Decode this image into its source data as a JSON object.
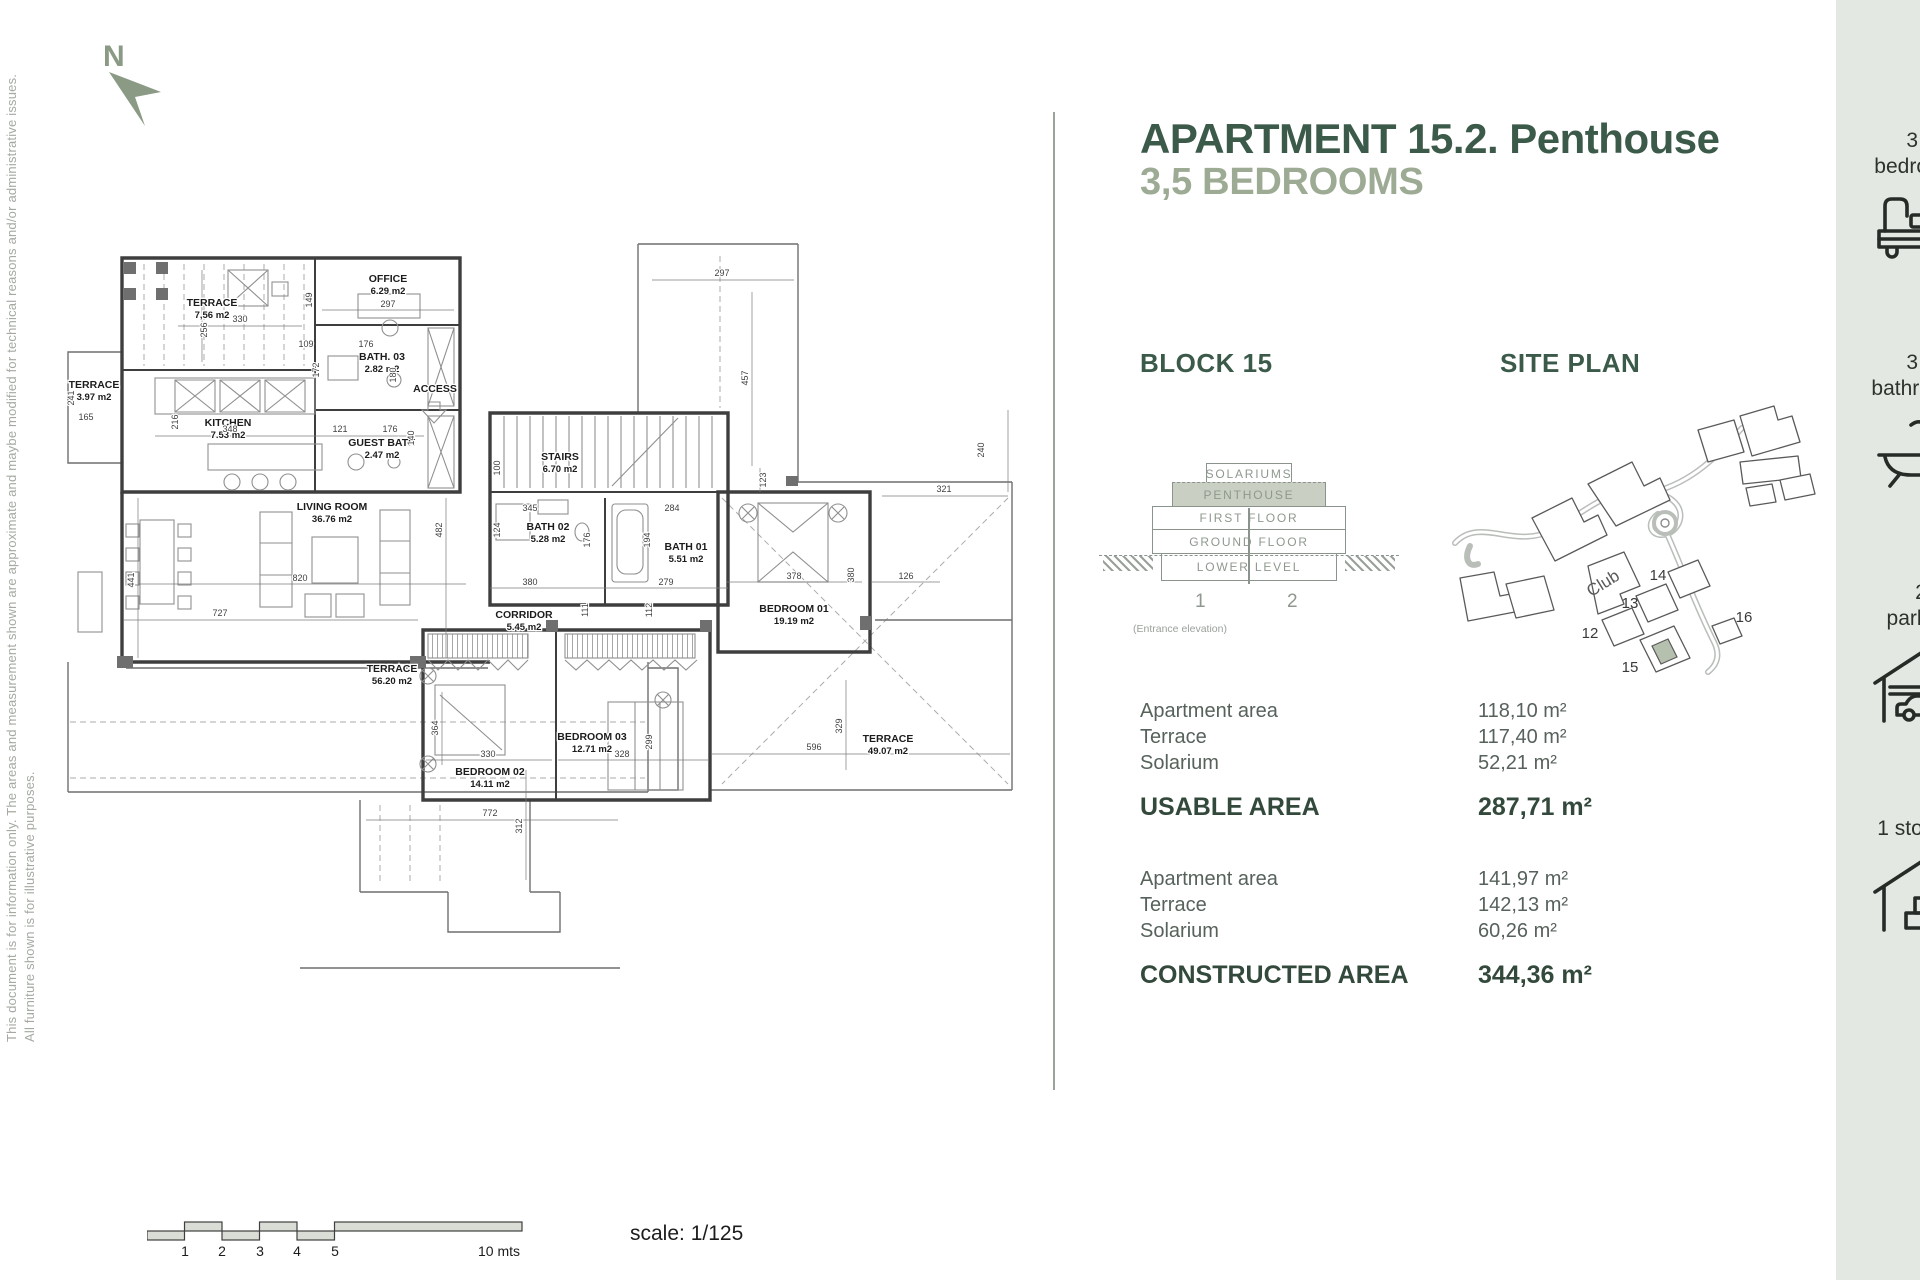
{
  "page_title_line1": "APARTMENT 15.2. Penthouse",
  "page_title_line2": "3,5 BEDROOMS",
  "north_label": "N",
  "disclaimers": {
    "line1": "This document is for information only. The areas and measurement shown are approximate and maybe modified for technical reasons and/or administrative issues.",
    "line2": "All furniture shown is for illustrative purposes."
  },
  "colors": {
    "accent_dark_green": "#3c5a4a",
    "accent_sage": "#9dab95",
    "sidebar_bg": "#e4e8e2",
    "penthouse_fill": "#c9d0c3"
  },
  "floor_plan": {
    "access": {
      "label": "ACCESS",
      "x": 375,
      "y": 162
    },
    "rooms": [
      {
        "label": "TERRACE",
        "area": "7,56 m2",
        "x": 152,
        "y": 76
      },
      {
        "label": "OFFICE",
        "area": "6.29 m2",
        "x": 328,
        "y": 52
      },
      {
        "label": "BATH. 03",
        "area": "2.82 m2",
        "x": 322,
        "y": 130
      },
      {
        "label": "KITCHEN",
        "area": "7.53 m2",
        "x": 168,
        "y": 196
      },
      {
        "label": "GUEST BATH",
        "area": "2.47 m2",
        "x": 322,
        "y": 216
      },
      {
        "label": "TERRACE",
        "area": "3.97 m2",
        "x": 34,
        "y": 158
      },
      {
        "label": "STAIRS",
        "area": "6.70 m2",
        "x": 500,
        "y": 230
      },
      {
        "label": "BATH 02",
        "area": "5.28 m2",
        "x": 488,
        "y": 300
      },
      {
        "label": "BATH 01",
        "area": "5.51 m2",
        "x": 626,
        "y": 320
      },
      {
        "label": "CORRIDOR",
        "area": "5.45 m2",
        "x": 464,
        "y": 388
      },
      {
        "label": "LIVING ROOM",
        "area": "36.76 m2",
        "x": 272,
        "y": 280
      },
      {
        "label": "TERRACE",
        "area": "56.20 m2",
        "x": 332,
        "y": 442
      },
      {
        "label": "BEDROOM 02",
        "area": "14.11 m2",
        "x": 430,
        "y": 545
      },
      {
        "label": "BEDROOM 03",
        "area": "12.71 m2",
        "x": 532,
        "y": 510
      },
      {
        "label": "BEDROOM 01",
        "area": "19.19 m2",
        "x": 734,
        "y": 382
      },
      {
        "label": "TERRACE",
        "area": "49.07 m2",
        "x": 828,
        "y": 512
      }
    ],
    "dimensions": [
      {
        "v": "256",
        "x": 147,
        "y": 100,
        "r": -90
      },
      {
        "v": "330",
        "x": 180,
        "y": 92
      },
      {
        "v": "149",
        "x": 252,
        "y": 70,
        "r": -90
      },
      {
        "v": "297",
        "x": 328,
        "y": 77
      },
      {
        "v": "109",
        "x": 246,
        "y": 117
      },
      {
        "v": "176",
        "x": 306,
        "y": 117
      },
      {
        "v": "172",
        "x": 259,
        "y": 140,
        "r": -90
      },
      {
        "v": "180",
        "x": 336,
        "y": 145,
        "r": -90
      },
      {
        "v": "216",
        "x": 118,
        "y": 192,
        "r": -90
      },
      {
        "v": "348",
        "x": 170,
        "y": 202
      },
      {
        "v": "121",
        "x": 280,
        "y": 202
      },
      {
        "v": "176",
        "x": 330,
        "y": 202
      },
      {
        "v": "140",
        "x": 354,
        "y": 208,
        "r": -90
      },
      {
        "v": "241",
        "x": 14,
        "y": 168,
        "r": -90
      },
      {
        "v": "165",
        "x": 26,
        "y": 190
      },
      {
        "v": "100",
        "x": 440,
        "y": 238,
        "r": -90
      },
      {
        "v": "482",
        "x": 382,
        "y": 300,
        "r": -90
      },
      {
        "v": "345",
        "x": 470,
        "y": 281
      },
      {
        "v": "124",
        "x": 440,
        "y": 300,
        "r": -90
      },
      {
        "v": "176",
        "x": 530,
        "y": 310,
        "r": -90
      },
      {
        "v": "380",
        "x": 470,
        "y": 355
      },
      {
        "v": "279",
        "x": 606,
        "y": 355
      },
      {
        "v": "111",
        "x": 528,
        "y": 380,
        "r": -90
      },
      {
        "v": "112",
        "x": 592,
        "y": 380,
        "r": -90
      },
      {
        "v": "284",
        "x": 612,
        "y": 281
      },
      {
        "v": "194",
        "x": 590,
        "y": 310,
        "r": -90
      },
      {
        "v": "820",
        "x": 240,
        "y": 351
      },
      {
        "v": "364",
        "x": 378,
        "y": 498,
        "r": -90
      },
      {
        "v": "330",
        "x": 428,
        "y": 527
      },
      {
        "v": "328",
        "x": 562,
        "y": 527
      },
      {
        "v": "299",
        "x": 592,
        "y": 512,
        "r": -90
      },
      {
        "v": "378",
        "x": 734,
        "y": 349
      },
      {
        "v": "380",
        "x": 794,
        "y": 345,
        "r": -90
      },
      {
        "v": "126",
        "x": 846,
        "y": 349
      },
      {
        "v": "321",
        "x": 884,
        "y": 262
      },
      {
        "v": "240",
        "x": 924,
        "y": 220,
        "r": -90
      },
      {
        "v": "123",
        "x": 706,
        "y": 250,
        "r": -90
      },
      {
        "v": "457",
        "x": 688,
        "y": 148,
        "r": -90
      },
      {
        "v": "297",
        "x": 662,
        "y": 46
      },
      {
        "v": "329",
        "x": 782,
        "y": 496,
        "r": -90
      },
      {
        "v": "596",
        "x": 754,
        "y": 520
      },
      {
        "v": "727",
        "x": 160,
        "y": 386
      },
      {
        "v": "441",
        "x": 74,
        "y": 350,
        "r": -90
      },
      {
        "v": "772",
        "x": 430,
        "y": 586
      },
      {
        "v": "312",
        "x": 462,
        "y": 596,
        "r": -90
      }
    ]
  },
  "block_section": {
    "heading": "BLOCK 15",
    "levels": [
      "SOLARIUMS",
      "PENTHOUSE",
      "FIRST FLOOR",
      "GROUND FLOOR",
      "LOWER LEVEL"
    ],
    "highlighted_level": "PENTHOUSE",
    "units": [
      "1",
      "2"
    ],
    "caption": "(Entrance elevation)"
  },
  "site_plan": {
    "heading": "SITE PLAN",
    "labels": [
      {
        "t": "Club",
        "x": 166,
        "y": 200,
        "r": -32
      },
      {
        "t": "14",
        "x": 218,
        "y": 192
      },
      {
        "t": "13",
        "x": 190,
        "y": 220
      },
      {
        "t": "12",
        "x": 150,
        "y": 250
      },
      {
        "t": "15",
        "x": 190,
        "y": 284
      },
      {
        "t": "16",
        "x": 304,
        "y": 234
      }
    ]
  },
  "areas": {
    "usable": {
      "rows": [
        {
          "label": "Apartment area",
          "value": "118,10 m²"
        },
        {
          "label": "Terrace",
          "value": "117,40 m²"
        },
        {
          "label": "Solarium",
          "value": "52,21 m²"
        }
      ],
      "total_label": "USABLE AREA",
      "total_value": "287,71 m²"
    },
    "constructed": {
      "rows": [
        {
          "label": "Apartment area",
          "value": "141,97 m²"
        },
        {
          "label": "Terrace",
          "value": "142,13 m²"
        },
        {
          "label": "Solarium",
          "value": "60,26 m²"
        }
      ],
      "total_label": "CONSTRUCTED AREA",
      "total_value": "344,36 m²"
    }
  },
  "sidebar": {
    "items": [
      {
        "line1": "3,5",
        "line2": "bedrooms",
        "icon": "bed-icon"
      },
      {
        "line1": "3,5",
        "line2": "bathrooms",
        "icon": "bathtub-icon"
      },
      {
        "line1": "2",
        "line2": "parking",
        "icon": "garage-icon"
      },
      {
        "line1": "1 storage",
        "line2": "",
        "icon": "storage-icon"
      }
    ]
  },
  "scale_bar": {
    "ticks": [
      {
        "t": "1",
        "x": 38
      },
      {
        "t": "2",
        "x": 75
      },
      {
        "t": "3",
        "x": 113
      },
      {
        "t": "4",
        "x": 150
      },
      {
        "t": "5",
        "x": 188
      }
    ],
    "end_label": {
      "t": "10 mts",
      "x": 352
    },
    "scale_text": "scale: 1/125"
  }
}
